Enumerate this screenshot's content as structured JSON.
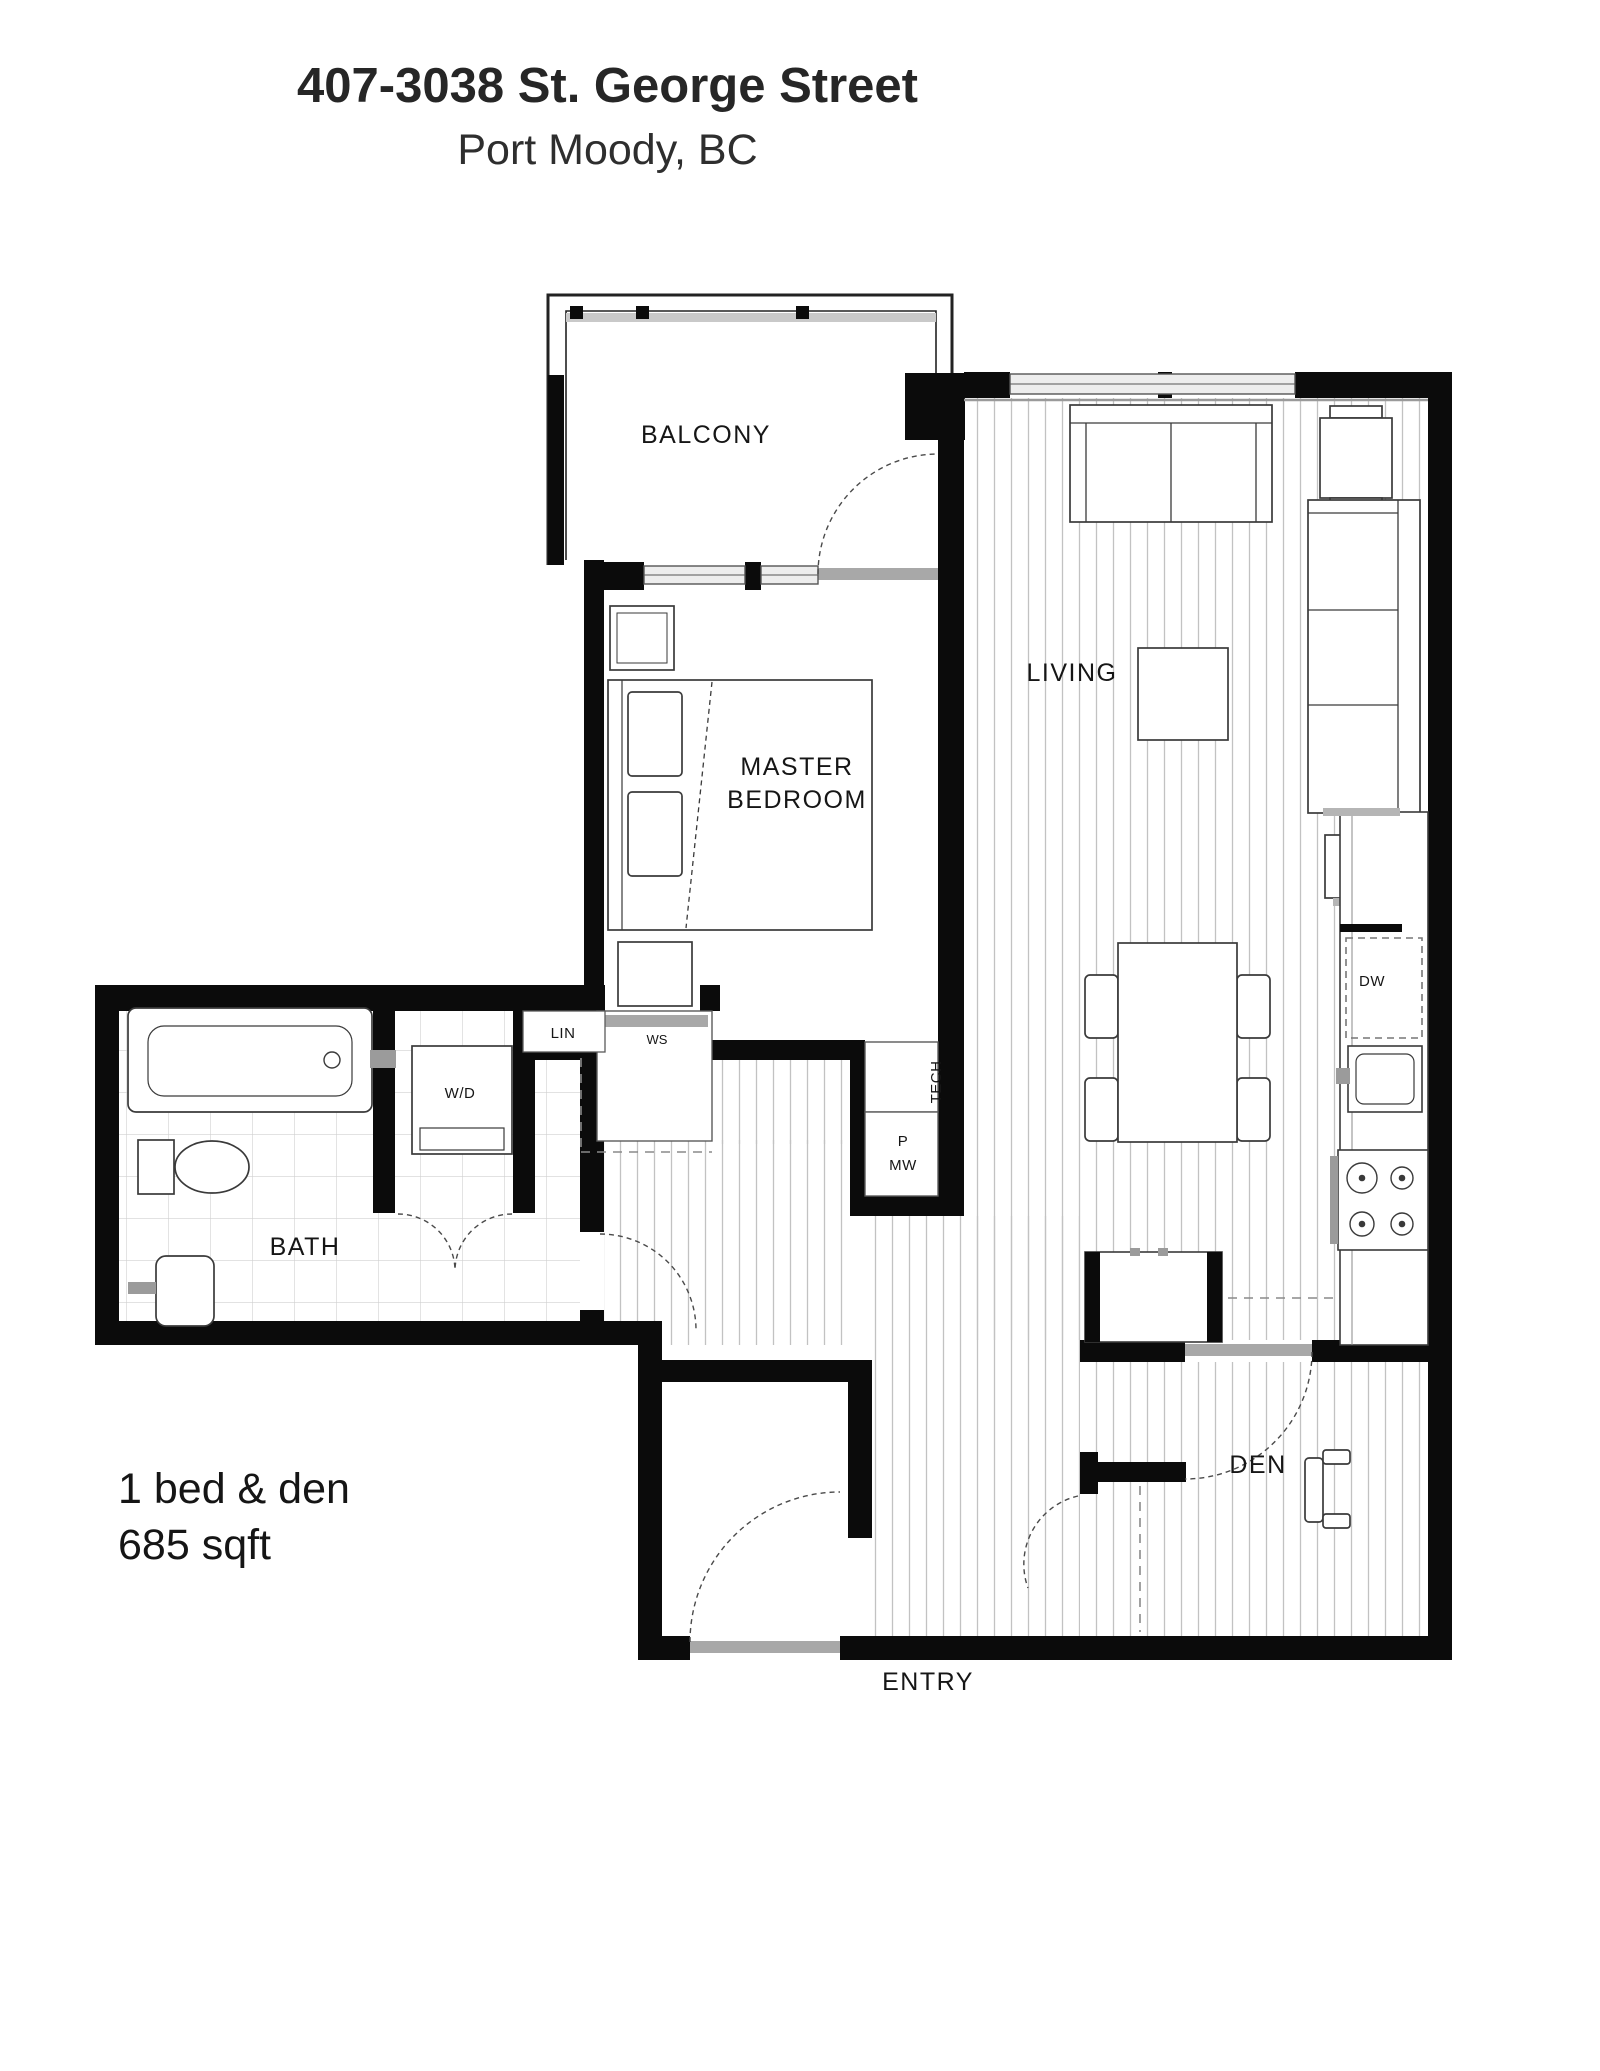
{
  "header": {
    "title": "407-3038 St. George Street",
    "subtitle": "Port Moody, BC"
  },
  "summary": {
    "line1": "1 bed & den",
    "line2": "685 sqft"
  },
  "rooms": {
    "balcony": "BALCONY",
    "living": "LIVING",
    "master_line1": "MASTER",
    "master_line2": "BEDROOM",
    "bath": "BATH",
    "den": "DEN",
    "entry": "ENTRY"
  },
  "closets": {
    "wd": "W/D",
    "lin": "LIN",
    "ws": "WS",
    "tech": "TECH",
    "pantry_line1": "P",
    "pantry_line2": "MW",
    "dw": "DW"
  },
  "colors": {
    "wall": "#0b0b0b",
    "furniture_line": "#3a3a3a",
    "plank_line": "#c2c2c2",
    "tile_line": "#d0d0d0",
    "door_slab": "#a8a8a8",
    "text": "#1a1a1a"
  }
}
